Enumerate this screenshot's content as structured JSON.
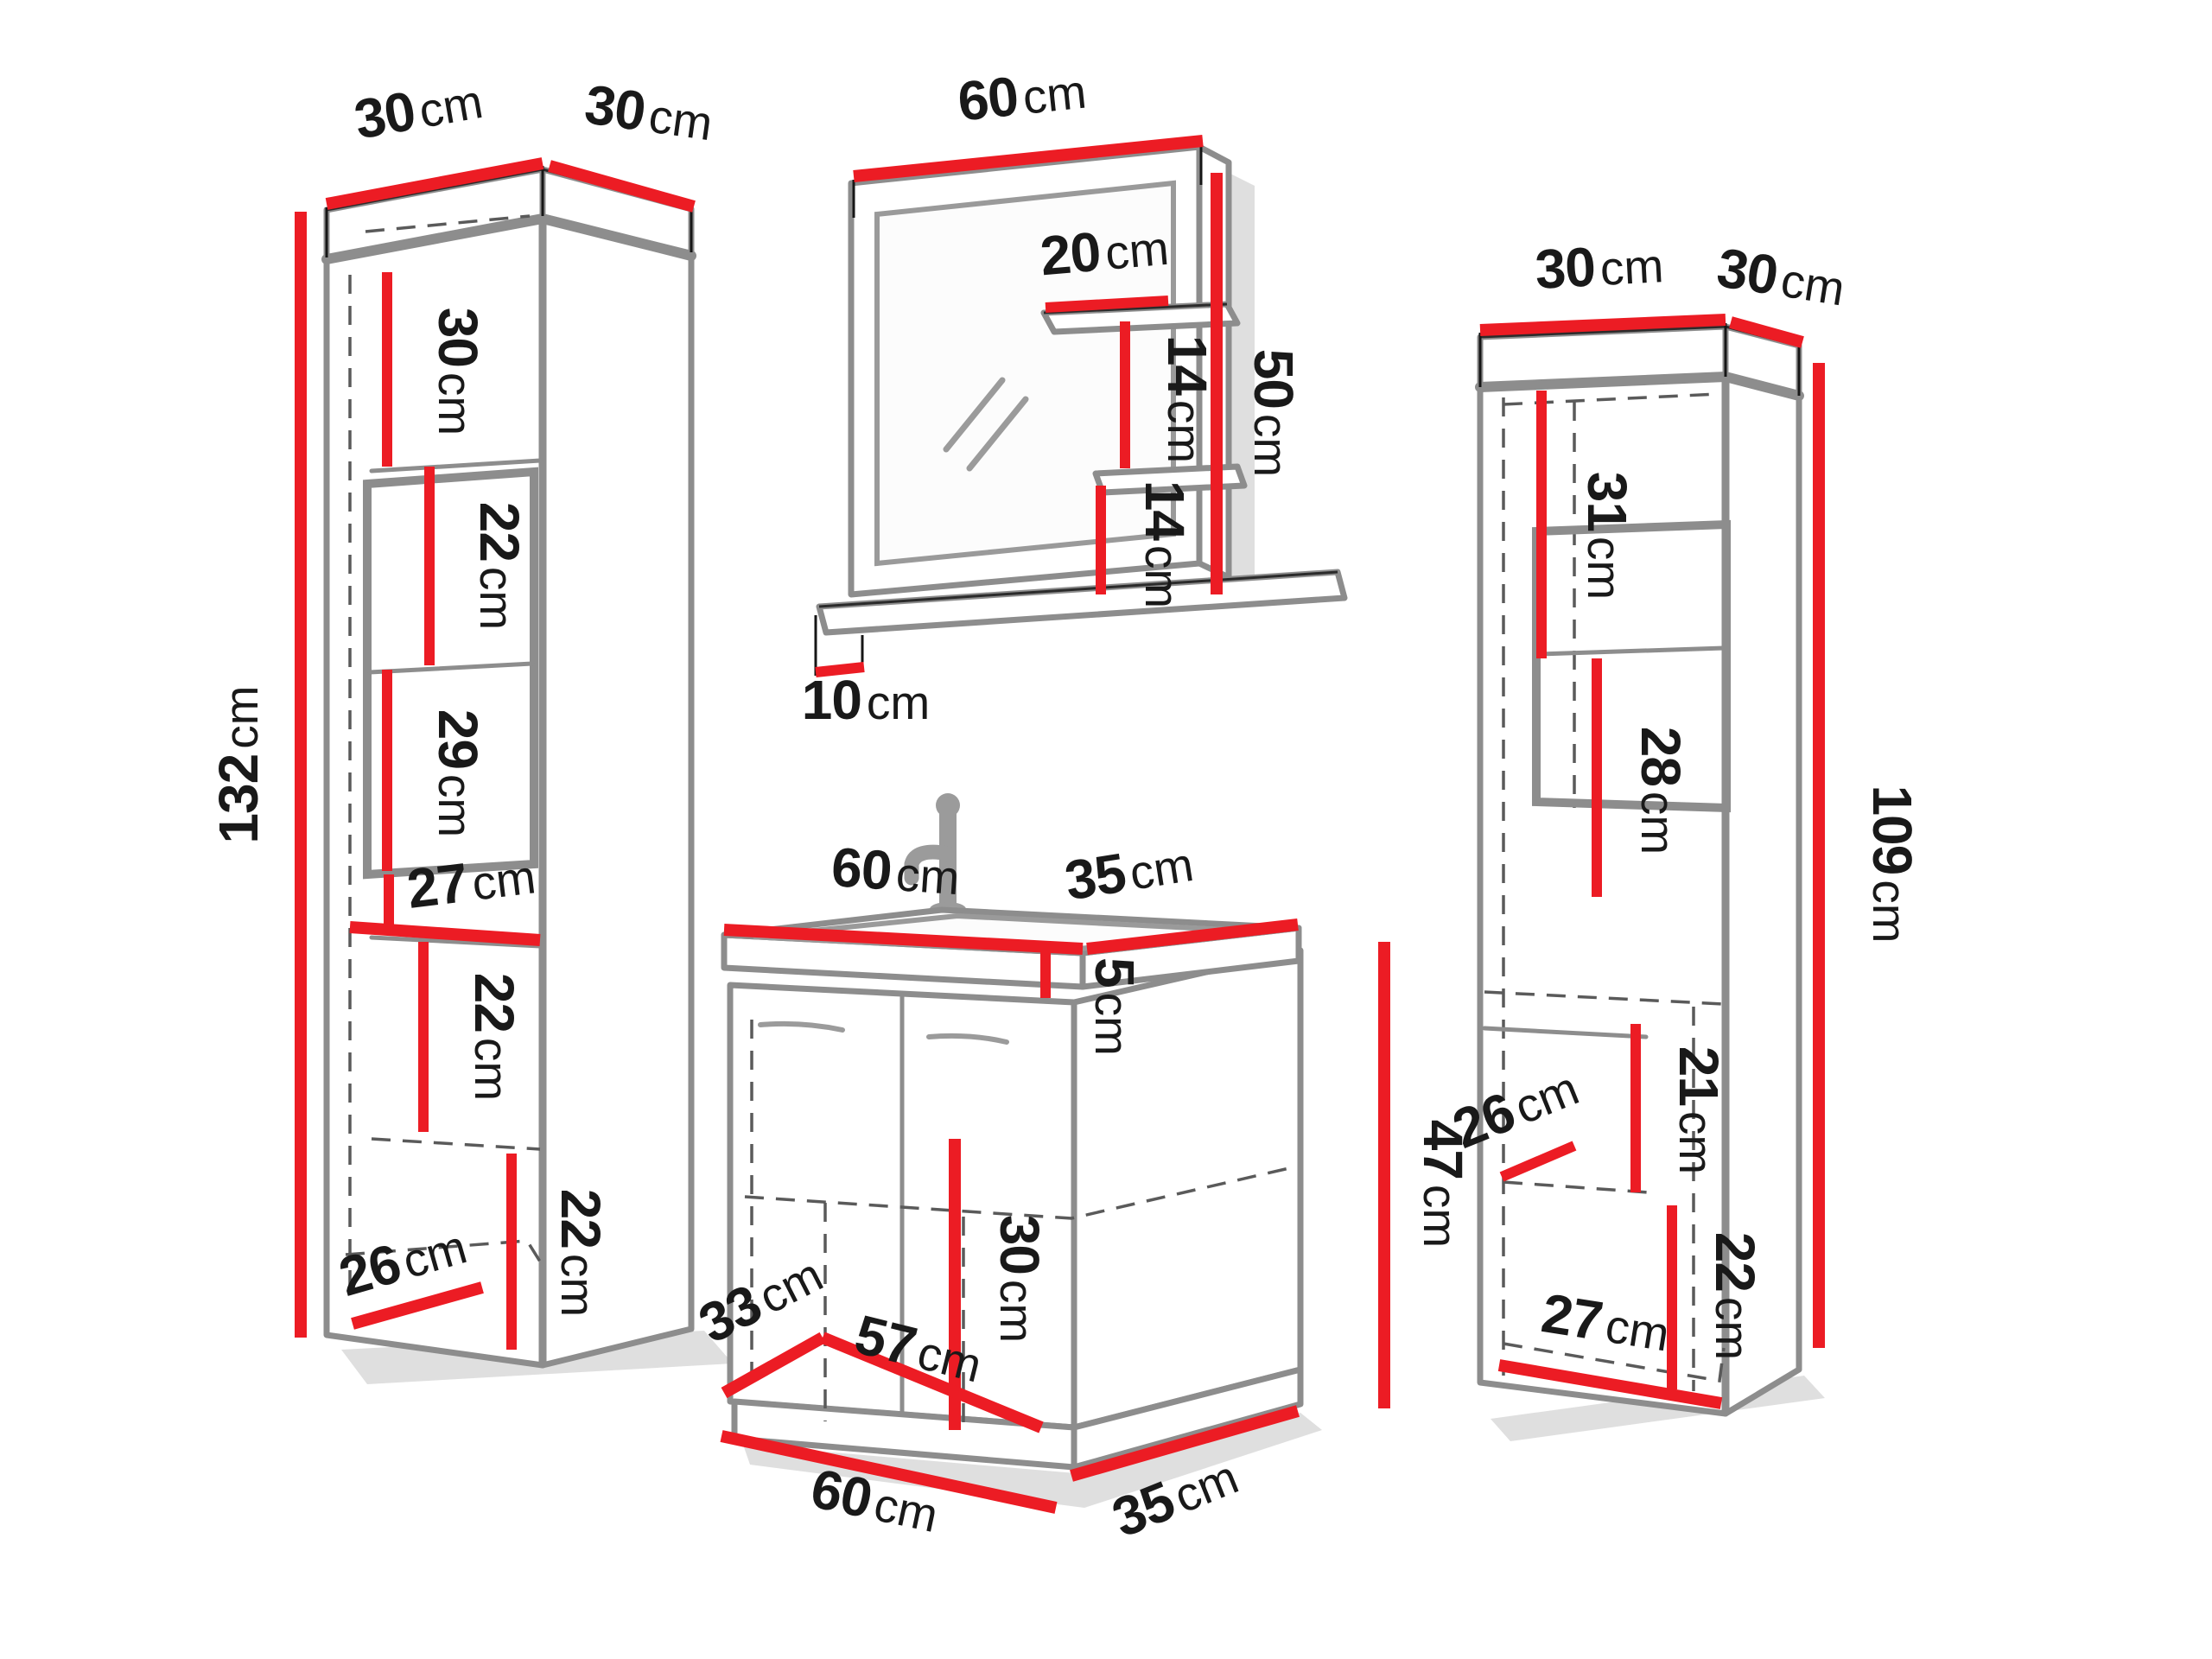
{
  "title": "Bathroom furniture set dimension diagram",
  "colors": {
    "dimension_line": "#ec1c24",
    "outline": "#2b2b2b",
    "panel_edge": "#8d8d8d",
    "text": "#191919",
    "background": "#ffffff"
  },
  "labels": {
    "left_cabinet": {
      "width": {
        "value": "30",
        "unit": "cm"
      },
      "depth": {
        "value": "30",
        "unit": "cm"
      },
      "height": {
        "value": "132",
        "unit": "cm"
      },
      "shelf_1": {
        "value": "30",
        "unit": "cm"
      },
      "shelf_2": {
        "value": "22",
        "unit": "cm"
      },
      "shelf_3": {
        "value": "29",
        "unit": "cm"
      },
      "shelf_4_width": {
        "value": "27",
        "unit": "cm"
      },
      "shelf_5": {
        "value": "22",
        "unit": "cm"
      },
      "shelf_6": {
        "value": "22",
        "unit": "cm"
      },
      "bottom_depth": {
        "value": "26",
        "unit": "cm"
      }
    },
    "mirror": {
      "width": {
        "value": "60",
        "unit": "cm"
      },
      "height": {
        "value": "50",
        "unit": "cm"
      },
      "shelf_width": {
        "value": "20",
        "unit": "cm"
      },
      "gap_top": {
        "value": "14",
        "unit": "cm"
      },
      "gap_bottom": {
        "value": "14",
        "unit": "cm"
      },
      "ledge_depth": {
        "value": "10",
        "unit": "cm"
      }
    },
    "sink": {
      "top_width": {
        "value": "60",
        "unit": "cm"
      },
      "top_depth": {
        "value": "35",
        "unit": "cm"
      },
      "basin_height": {
        "value": "5",
        "unit": "cm"
      },
      "height": {
        "value": "47",
        "unit": "cm"
      },
      "door_span": {
        "value": "30",
        "unit": "cm"
      },
      "floor_depth": {
        "value": "33",
        "unit": "cm"
      },
      "floor_width": {
        "value": "57",
        "unit": "cm"
      },
      "base_width": {
        "value": "60",
        "unit": "cm"
      },
      "base_depth": {
        "value": "35",
        "unit": "cm"
      }
    },
    "right_cabinet": {
      "width": {
        "value": "30",
        "unit": "cm"
      },
      "depth": {
        "value": "30",
        "unit": "cm"
      },
      "height": {
        "value": "109",
        "unit": "cm"
      },
      "shelf_1": {
        "value": "31",
        "unit": "cm"
      },
      "niche_height": {
        "value": "28",
        "unit": "cm"
      },
      "mid_depth": {
        "value": "26",
        "unit": "cm"
      },
      "shelf_3": {
        "value": "21",
        "unit": "cm"
      },
      "shelf_4": {
        "value": "22",
        "unit": "cm"
      },
      "bottom_width": {
        "value": "27",
        "unit": "cm"
      }
    }
  }
}
